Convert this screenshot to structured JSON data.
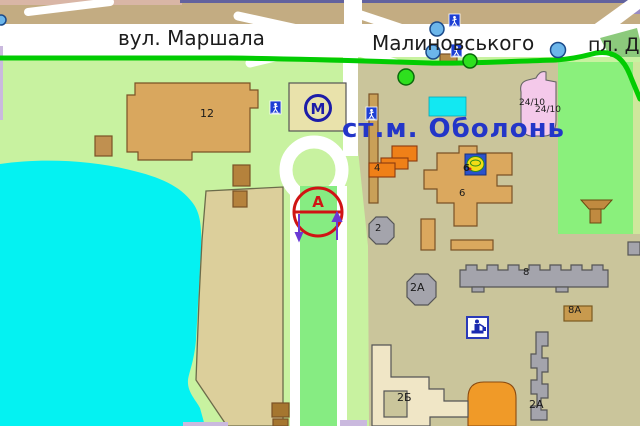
{
  "map": {
    "streets": {
      "marshala": "вул. Маршала",
      "malynovskoho": "Малиновського",
      "square": "пл. Д"
    },
    "metro": {
      "station_label": "ст.м. Оболонь",
      "symbol": "М"
    },
    "bus_terminus": {
      "symbol": "А"
    },
    "buildings": {
      "b12": "12",
      "b4": "4",
      "b6_top": "6",
      "b6": "6",
      "b2": "2",
      "b2a_octagon": "2А",
      "b8": "8",
      "b8a": "8А",
      "b2a_strip": "2А",
      "b2b": "2Б",
      "b24_label1": "24/10",
      "b24_label2": "24/10"
    },
    "icons": {
      "pedestrian_crossing": "pedestrian-crossing-icon",
      "metro_entrance_stop_blue": "stop-marker-blue",
      "stop_green": "stop-marker-green",
      "monument": "monument-icon",
      "supermarket_logo": "supermarket-logo",
      "bus_terminus_circle": "bus-terminus-icon"
    },
    "colors": {
      "land": "#c8f2a0",
      "plaza": "#cac59b",
      "park": "#8af07c",
      "lake": "#04f2f2",
      "road": "#ffffff",
      "road_median": "#86ec82",
      "route_line": "#02cc02",
      "building_tan": "#dba85e",
      "building_gray": "#a4a4ac",
      "building_orange": "#ef8018",
      "building_cream": "#f0e6c6",
      "building_pink": "#f4c9ea",
      "pool_cyan": "#12e8f2",
      "metro_blue": "#1c1ca8",
      "terminus_red": "#d01414",
      "arrow_purple": "#6a3ad4",
      "lavender_road": "#cab9de",
      "top_band_tan": "#c3ac82"
    }
  }
}
